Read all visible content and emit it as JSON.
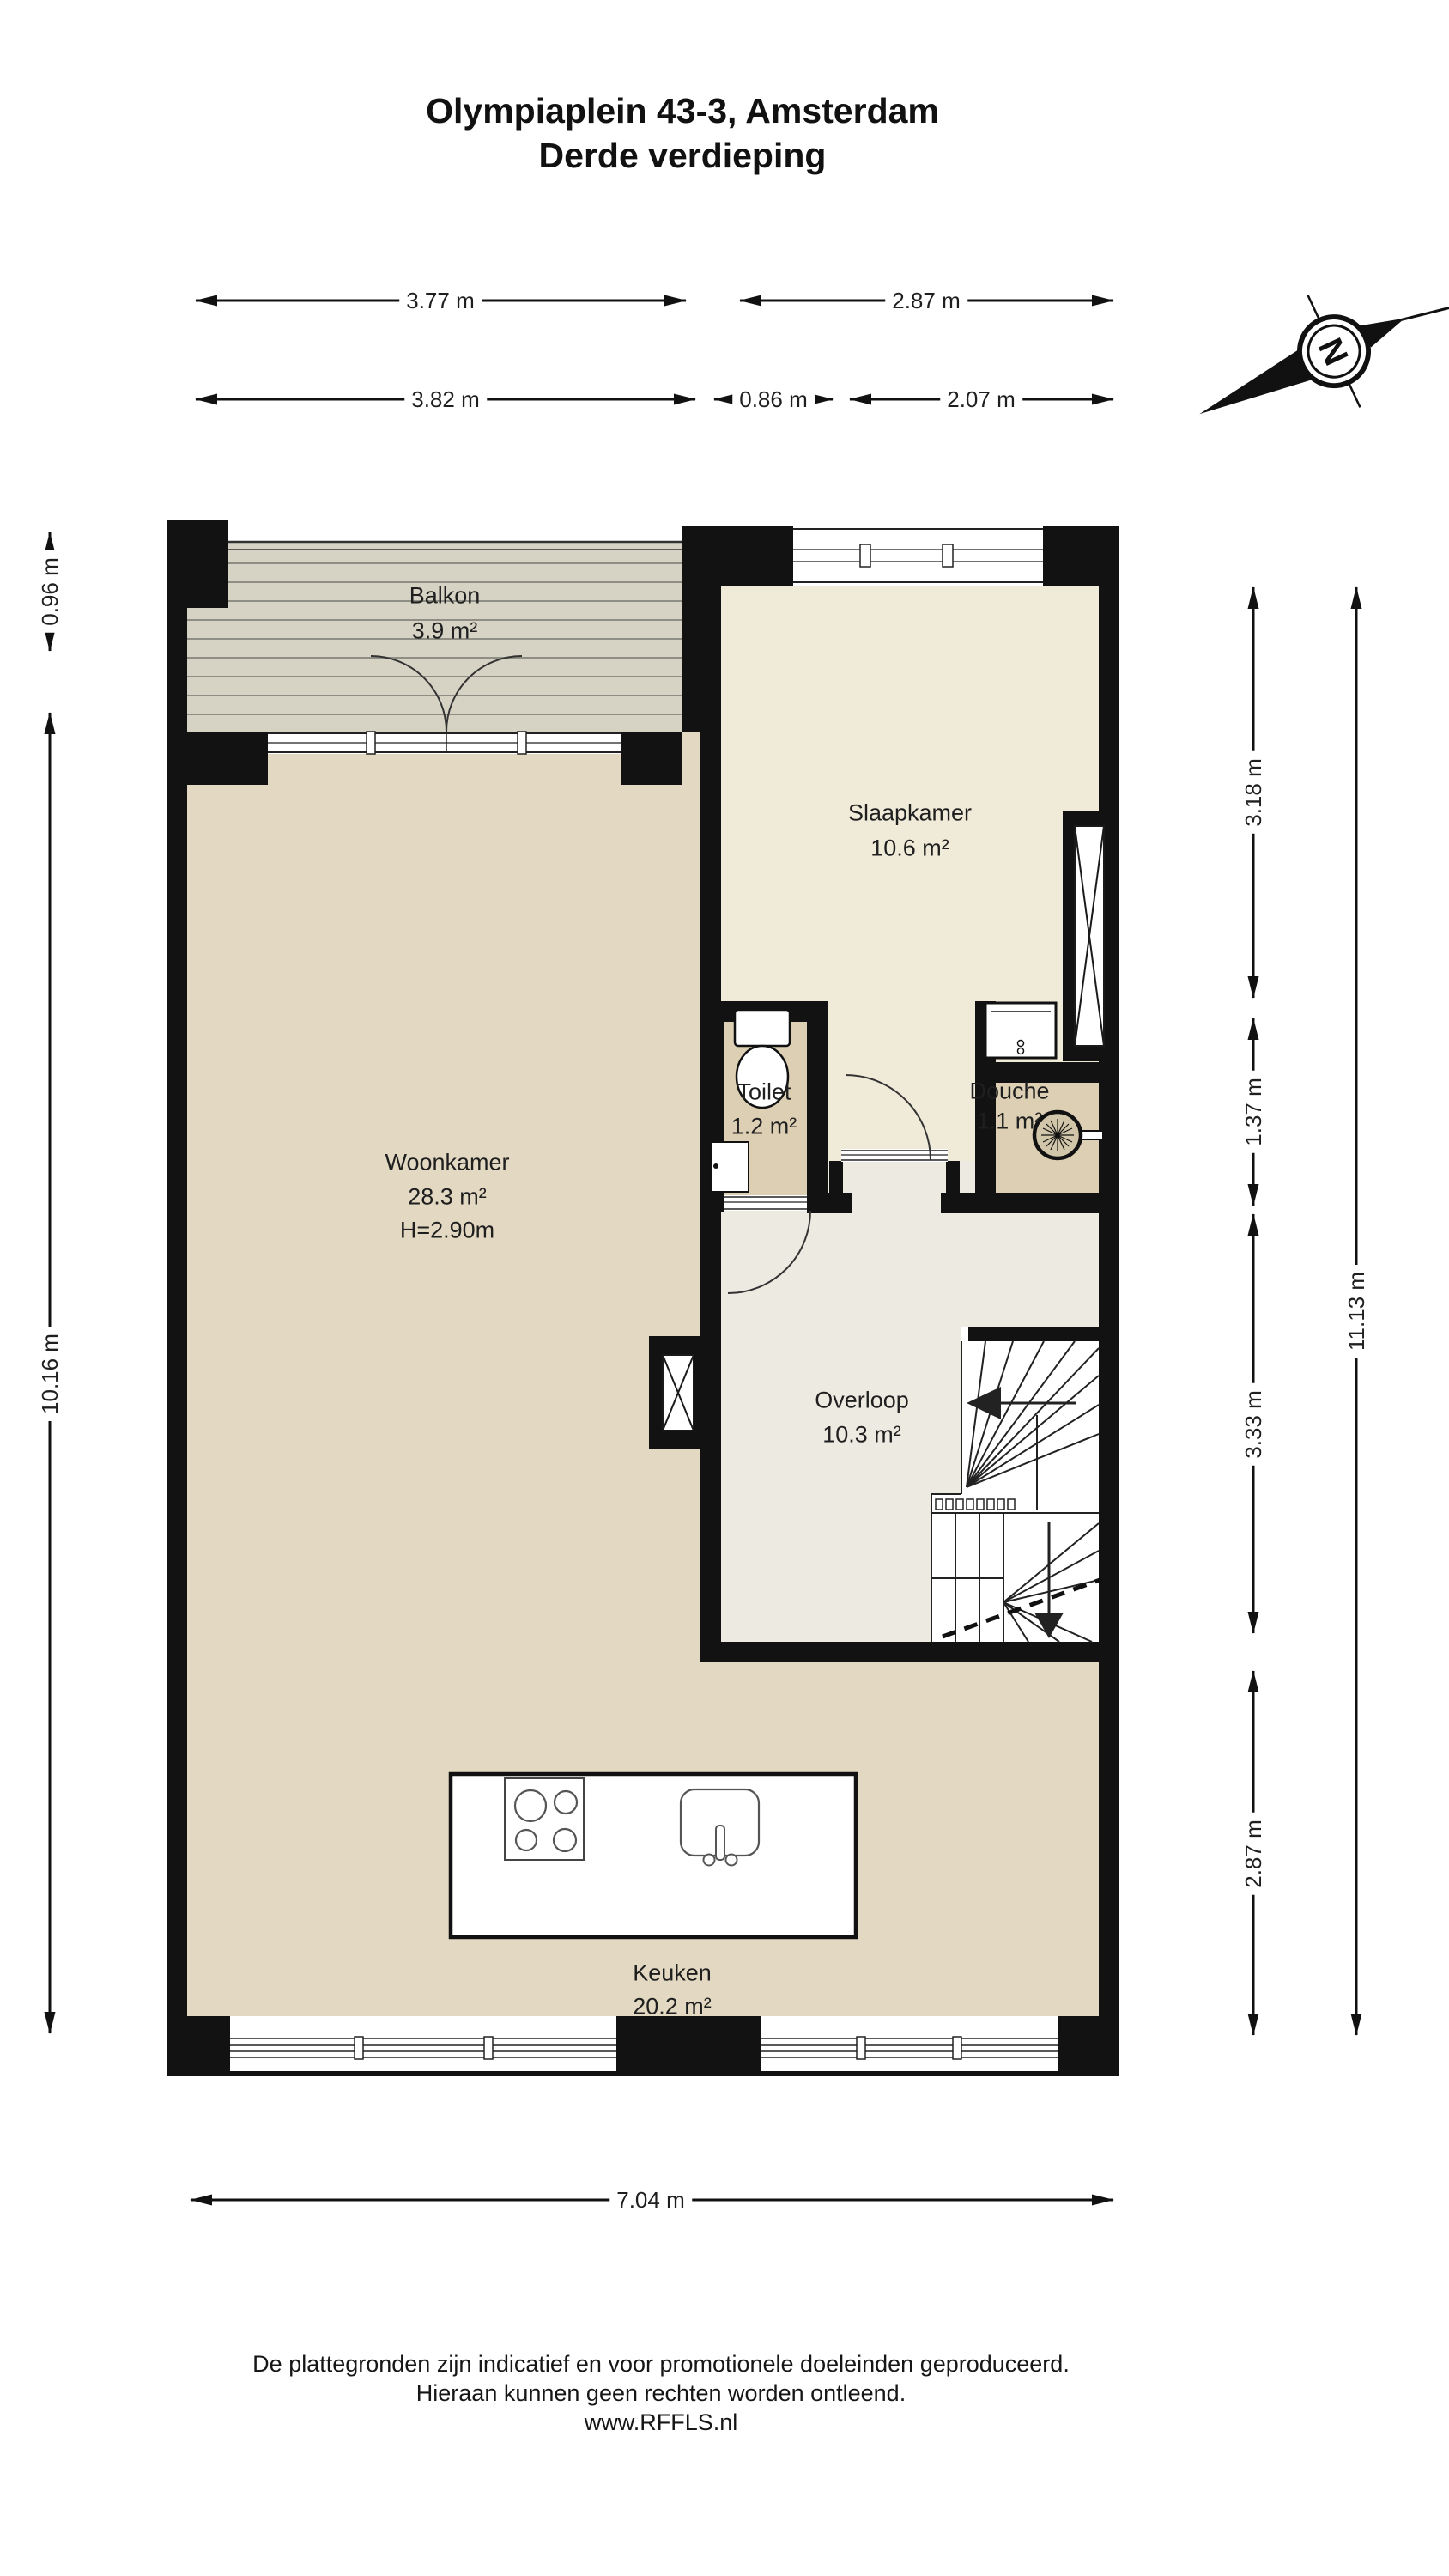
{
  "title": {
    "line1": "Olympiaplein 43-3, Amsterdam",
    "line2": "Derde verdieping"
  },
  "compass": {
    "label": "N"
  },
  "rooms": {
    "balkon": {
      "name": "Balkon",
      "area": "3.9 m²"
    },
    "slaapkamer": {
      "name": "Slaapkamer",
      "area": "10.6 m²"
    },
    "woonkamer": {
      "name": "Woonkamer",
      "area": "28.3 m²",
      "ceiling": "H=2.90m"
    },
    "toilet": {
      "name": "Toilet",
      "area": "1.2 m²"
    },
    "douche": {
      "name": "Douche",
      "area": "1.1 m²"
    },
    "overloop": {
      "name": "Overloop",
      "area": "10.3 m²"
    },
    "keuken": {
      "name": "Keuken",
      "area": "20.2 m²"
    }
  },
  "dimensions": {
    "top_outer_left": "3.77 m",
    "top_outer_right": "2.87 m",
    "top_inner_left": "3.82 m",
    "top_inner_mid": "0.86 m",
    "top_inner_right": "2.07 m",
    "left_balcony": "0.96 m",
    "left_total": "10.16 m",
    "right_seg_1": "3.18 m",
    "right_seg_2": "1.37 m",
    "right_seg_3": "3.33 m",
    "right_seg_4": "2.87 m",
    "right_total": "11.13 m",
    "bottom_total": "7.04 m"
  },
  "footer": {
    "line1": "De plattegronden zijn indicatief en voor promotionele doeleinden geproduceerd.",
    "line2": "Hieraan kunnen geen rechten worden ontleend.",
    "line3": "www.RFFLS.nl"
  },
  "colors": {
    "wall": "#121212",
    "floor_main": "#e3d8c2",
    "floor_bedroom": "#f0ead9",
    "floor_landing": "#edeae1",
    "floor_bath": "#dccfb4",
    "balcony_deck": "#d6d3c5",
    "balcony_line": "#8f8e85"
  }
}
